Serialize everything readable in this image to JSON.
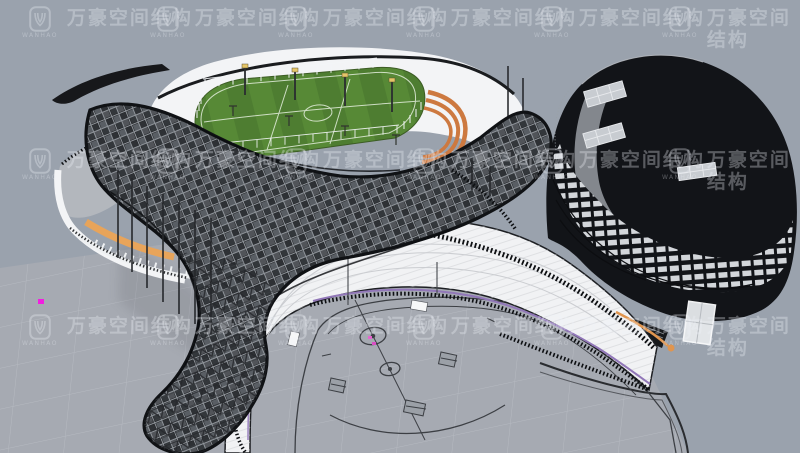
{
  "viewport": {
    "width": 800,
    "height": 453
  },
  "watermark": {
    "brand_cn": "万豪空间结构",
    "brand_latin": "WANHAO",
    "tile_color": "rgba(238,242,248,0.32)"
  },
  "colors": {
    "background": "#9aa2ad",
    "plaza": "#a6aab2",
    "plaza_grid": "#c3c7cd",
    "court_line": "#3c3f44",
    "stand_white": "#f1f2f4",
    "stand_edge": "#1d1f23",
    "canopy_dark": "#1f2124",
    "canopy_panel": "#595e64",
    "canopy_frame": "#8f949a",
    "building_dark": "#121418",
    "building_window": "#d3d6da",
    "field_green": "#4e7d31",
    "field_stripe": "#578936",
    "field_line": "#e4eedd",
    "track_orange": "#cd7940",
    "balcony_orange": "#e8a45a",
    "accent_purple": "#9177b8",
    "marker_magenta": "#f21ee0",
    "marker_pink": "#e564cf",
    "roof_white": "#f3f4f6",
    "light_cap_yellow": "#e5c568",
    "railing_dark": "#0d0f12",
    "terrace_gray": "#b3b7bd"
  }
}
